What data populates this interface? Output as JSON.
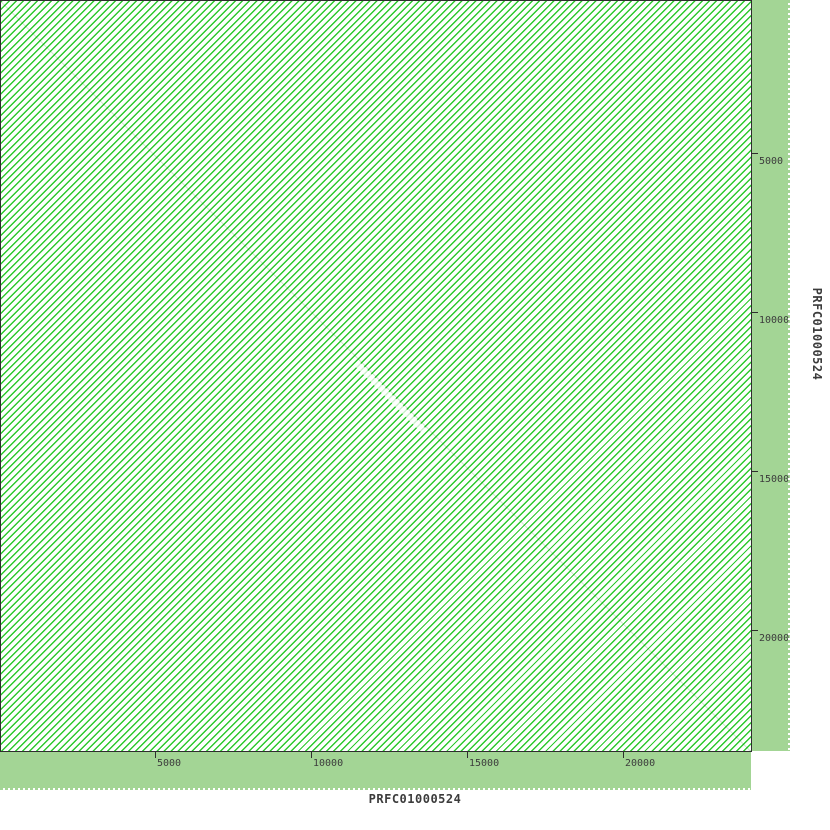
{
  "app": {
    "description": "DNA dotplot (self-alignment) view of sequence PRFC01000524 against itself"
  },
  "chart_data": {
    "type": "scatter",
    "subtype": "dna-dotplot-self-alignment",
    "title": "",
    "xlabel": "PRFC01000524",
    "ylabel": "PRFC01000524",
    "x_ticks": [
      5000,
      10000,
      15000,
      20000
    ],
    "y_ticks": [
      5000,
      10000,
      15000,
      20000
    ],
    "x_range_bp": [
      0,
      24000
    ],
    "y_range_bp": [
      0,
      24000
    ],
    "grid": false,
    "legend": false,
    "content_description": "Plot area is densely filled with parallel anti-diagonal (/) green match lines covering the whole 24 kb x 24 kb area, indicating a reverse-complement tandem repeat family with a period of roughly 220 bp; a very faint main identity diagonal runs from (0,0) to (24000,24000) with a short whitish gap band near 11.5-13.5 kb",
    "repeat_line_spacing_bp": 220,
    "repeat_line_direction": "anti-diagonal (/)",
    "main_diagonal": {
      "from": [
        0,
        0
      ],
      "to": [
        24000,
        24000
      ]
    }
  },
  "axes": {
    "x": {
      "title": "PRFC01000524",
      "tick_labels": [
        "5000",
        "10000",
        "15000",
        "20000"
      ]
    },
    "y": {
      "title": "PRFC01000524",
      "tick_labels": [
        "5000",
        "10000",
        "15000",
        "20000"
      ]
    }
  },
  "colors": {
    "margin_strip_green": "#a3d595",
    "hatch_line_green": "#2dc92d",
    "plot_background": "#fefffe",
    "border": "#2e2e2e",
    "text": "#3c3c3c",
    "page_background": "#ffffff"
  }
}
